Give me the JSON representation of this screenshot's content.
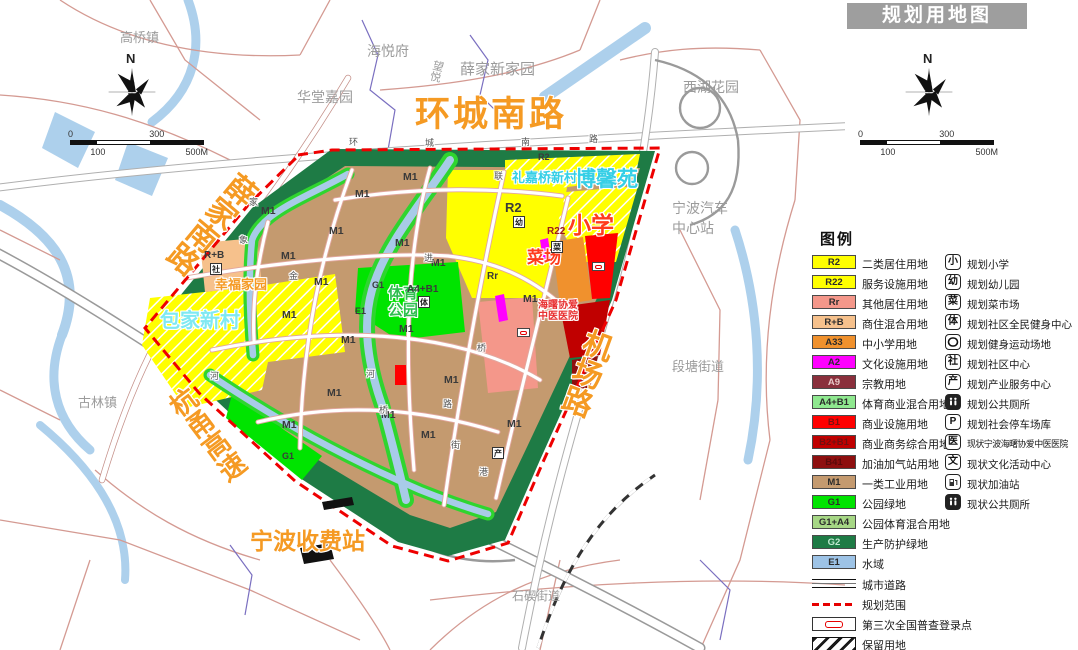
{
  "title": "规划用地图",
  "compass_label": "N",
  "scalebar": {
    "t0": "0",
    "t100": "100",
    "t300": "300",
    "t500": "500M"
  },
  "legend": {
    "header": "图例",
    "zones": [
      {
        "code": "R2",
        "label": "二类居住用地",
        "color": "#FFFF00"
      },
      {
        "code": "R22",
        "label": "服务设施用地",
        "color": "#FFFF00"
      },
      {
        "code": "Rr",
        "label": "其他居住用地",
        "color": "#F4978A"
      },
      {
        "code": "R+B",
        "label": "商住混合用地",
        "color": "#F6C18C"
      },
      {
        "code": "A33",
        "label": "中小学用地",
        "color": "#F0912D"
      },
      {
        "code": "A2",
        "label": "文化设施用地",
        "color": "#FF00FF"
      },
      {
        "code": "A9",
        "label": "宗教用地",
        "color": "#8A2F3C"
      },
      {
        "code": "A4+B1",
        "label": "体育商业混合用地",
        "color": "#8FE88F"
      },
      {
        "code": "B1",
        "label": "商业设施用地",
        "color": "#FF0000"
      },
      {
        "code": "B2+B1",
        "label": "商业商务综合用地",
        "color": "#C00000"
      },
      {
        "code": "B41",
        "label": "加油加气站用地",
        "color": "#8E0F0F"
      },
      {
        "code": "M1",
        "label": "一类工业用地",
        "color": "#C49A6F"
      },
      {
        "code": "G1",
        "label": "公园绿地",
        "color": "#00E400"
      },
      {
        "code": "G1+A4",
        "label": "公园体育混合用地",
        "color": "#A6D785"
      },
      {
        "code": "G2",
        "label": "生产防护绿地",
        "color": "#1E7B45"
      },
      {
        "code": "E1",
        "label": "水域",
        "color": "#9DC3E6"
      }
    ],
    "symbols": {
      "city_road": "城市道路",
      "boundary": "规划范围",
      "census": "第三次全国普查登录点",
      "reserved": "保留用地"
    },
    "markers": [
      {
        "glyph": "小",
        "label": "规划小学"
      },
      {
        "glyph": "幼",
        "label": "规划幼儿园"
      },
      {
        "glyph": "菜",
        "label": "规划菜市场"
      },
      {
        "glyph": "体",
        "label": "规划社区全民健身中心"
      },
      {
        "glyph": "",
        "label": "规划健身运动场地"
      },
      {
        "glyph": "社",
        "label": "规划社区中心"
      },
      {
        "glyph": "产",
        "label": "规划产业服务中心"
      },
      {
        "glyph": "",
        "label": "规划公共厕所"
      },
      {
        "glyph": "P",
        "label": "规划社会停车场库"
      },
      {
        "glyph": "医",
        "label": "现状宁波海曙协爱中医医院"
      },
      {
        "glyph": "文",
        "label": "现状文化活动中心"
      },
      {
        "glyph": "",
        "label": "现状加油站"
      },
      {
        "glyph": "",
        "label": "现状公共厕所"
      }
    ]
  },
  "map": {
    "road_labels": {
      "huancheng": "环城南路",
      "xuejia": "薛家南路",
      "jichang": "机场路",
      "hangyong": "杭甬高速",
      "shoufeizhan": "宁波收费站"
    },
    "places": {
      "gaoqiao": "高桥镇",
      "haiyuefu": "海悦府",
      "huatang": "华堂嘉园",
      "xuejiaxinjiayuan": "薛家新家园",
      "wangyue": "望悦",
      "xihu": "西湖花园",
      "qichezhan": "宁波汽车中心站",
      "duantang": "段塘街道",
      "gulin": "古林镇",
      "shiqi": "石碶街道"
    },
    "sites": {
      "boxinyuan": "博馨苑",
      "baojiaxincun": "包家新村",
      "lijiaqiao": "礼嘉桥新村",
      "xingfujiayuan": "幸福家园",
      "xiaoxue": "小学",
      "caichang": "菜场",
      "tiyugongyuan": "体育公园",
      "hospital": "海曙协爱中医医院"
    },
    "codes": {
      "m1": "M1",
      "r2": "R2",
      "r22": "R22",
      "rr": "Rr",
      "rb": "R+B",
      "a4b1": "A4+B1",
      "g1": "G1",
      "e1": "E1"
    },
    "road_chars": [
      "环",
      "城",
      "南",
      "路",
      "联",
      "进",
      "象",
      "金",
      "河",
      "桥",
      "桥",
      "路",
      "街",
      "港",
      "家",
      "河"
    ],
    "mini_icons": [
      "幼",
      "菜",
      "体",
      "社",
      "产"
    ]
  }
}
